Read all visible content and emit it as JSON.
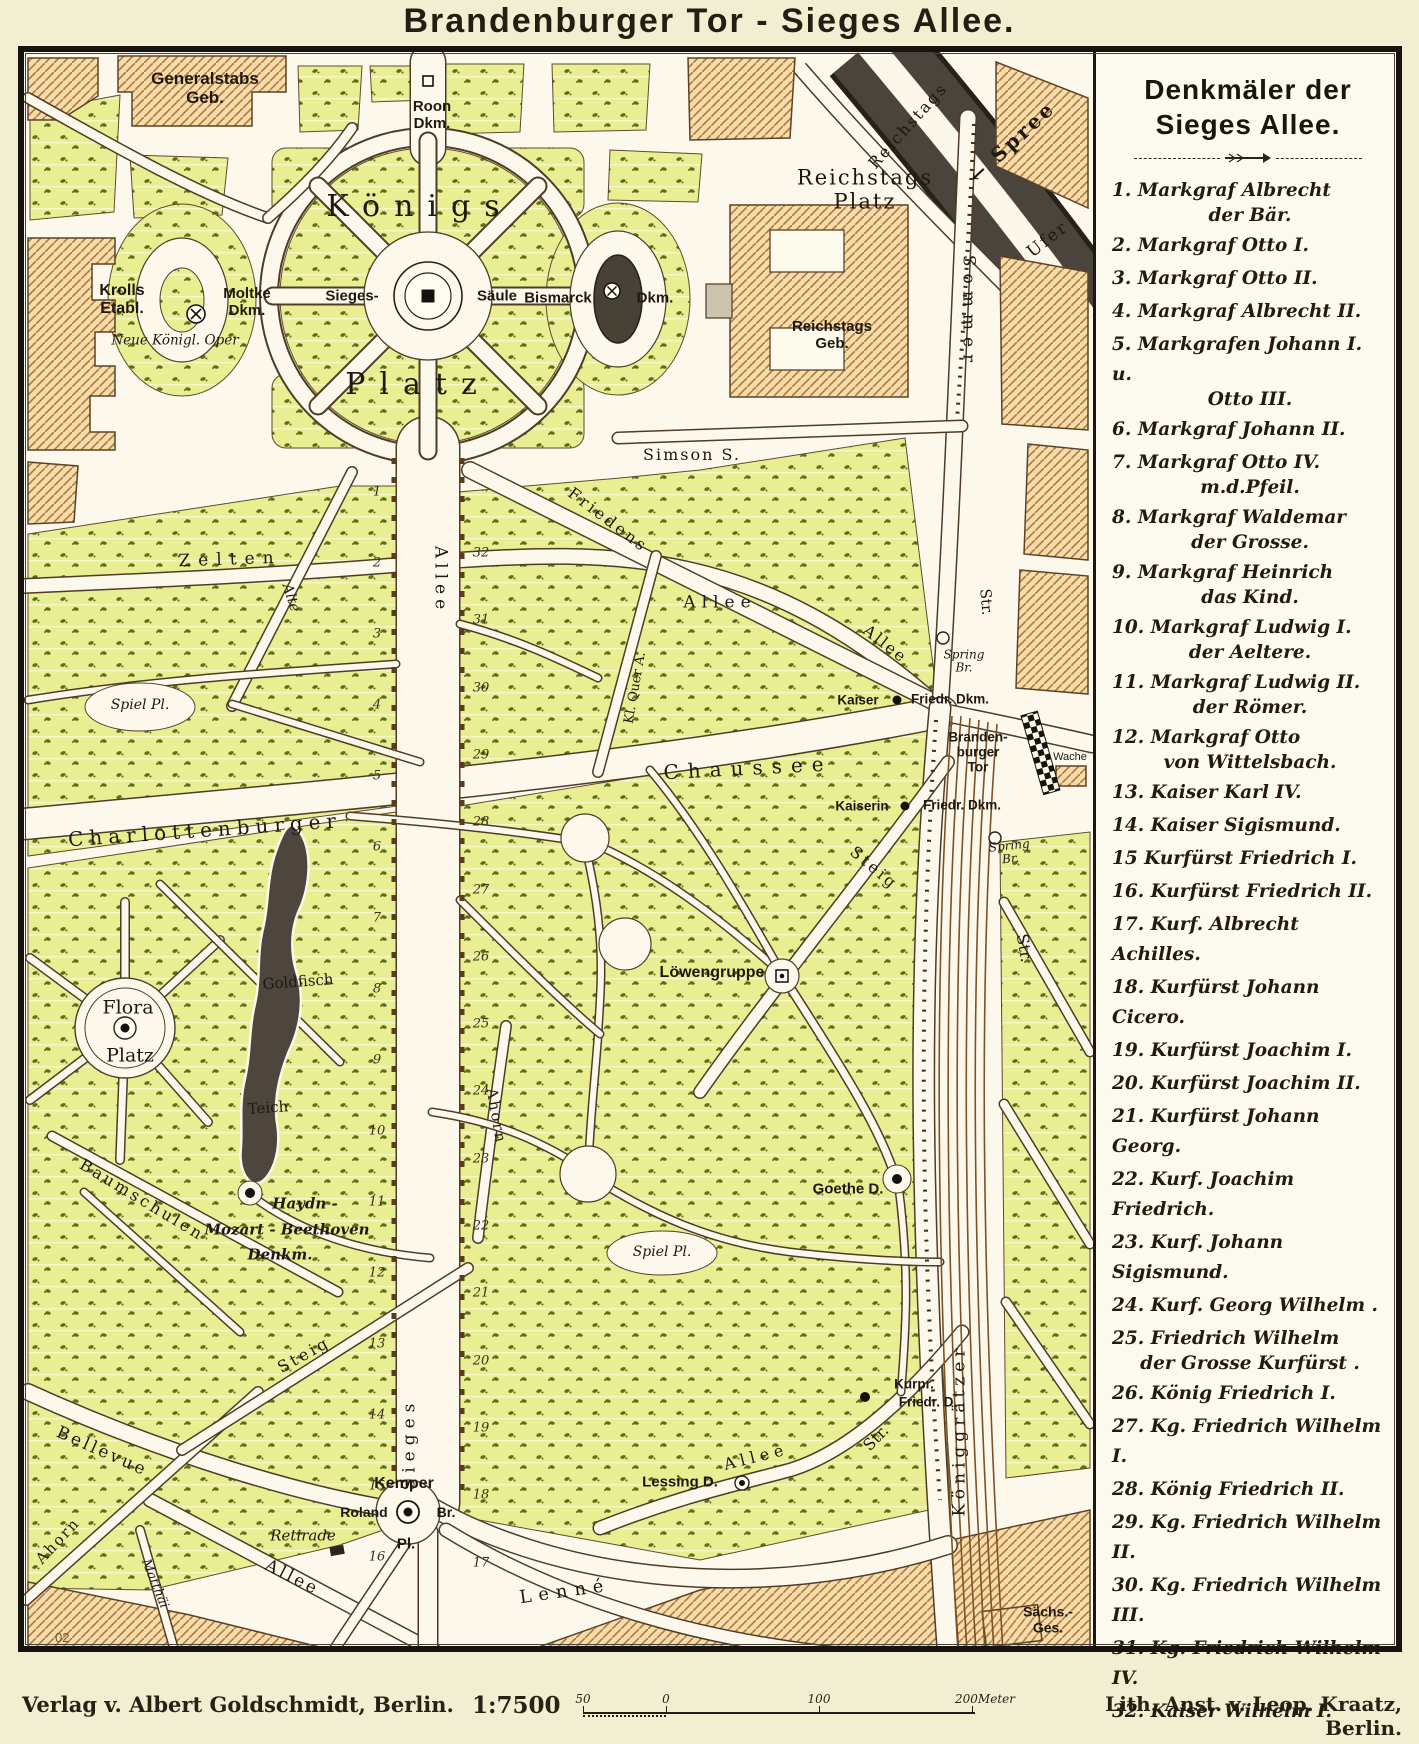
{
  "title": "Brandenburger Tor - Sieges Allee.",
  "colors": {
    "paper": "#f2eed2",
    "map_bg": "#fcf9ec",
    "park": "#e9ee92",
    "park_speckle": "#5b6c1e",
    "building_fill": "#f4dcab",
    "building_hatch": "#b5763d",
    "road_casing": "#4e3c27",
    "river_dark": "#4a443c",
    "frame": "#17130e",
    "text": "#1f1810"
  },
  "legend": {
    "title": "Denkmäler der\nSieges Allee.",
    "items": [
      {
        "n": "1.",
        "a": "Markgraf Albrecht",
        "b": "der Bär."
      },
      {
        "n": "2.",
        "a": "Markgraf Otto I.",
        "b": ""
      },
      {
        "n": "3.",
        "a": "Markgraf Otto II.",
        "b": ""
      },
      {
        "n": "4.",
        "a": "Markgraf Albrecht II.",
        "b": ""
      },
      {
        "n": "5.",
        "a": "Markgrafen Johann I. u.",
        "b": "Otto III."
      },
      {
        "n": "6.",
        "a": "Markgraf Johann II.",
        "b": ""
      },
      {
        "n": "7.",
        "a": "Markgraf Otto IV.",
        "b": "m.d.Pfeil."
      },
      {
        "n": "8.",
        "a": "Markgraf Waldemar",
        "b": "der Grosse."
      },
      {
        "n": "9.",
        "a": "Markgraf Heinrich",
        "b": "das Kind."
      },
      {
        "n": "10.",
        "a": "Markgraf Ludwig I.",
        "b": "der Aeltere."
      },
      {
        "n": "11.",
        "a": "Markgraf Ludwig II.",
        "b": "der Römer."
      },
      {
        "n": "12.",
        "a": "Markgraf Otto",
        "b": "von Wittelsbach."
      },
      {
        "n": "13.",
        "a": "Kaiser Karl IV.",
        "b": ""
      },
      {
        "n": "14.",
        "a": "Kaiser Sigismund.",
        "b": ""
      },
      {
        "n": "15",
        "a": "Kurfürst Friedrich I.",
        "b": ""
      },
      {
        "n": "16.",
        "a": "Kurfürst Friedrich II.",
        "b": ""
      },
      {
        "n": "17.",
        "a": "Kurf. Albrecht Achilles.",
        "b": ""
      },
      {
        "n": "18.",
        "a": "Kurfürst Johann Cicero.",
        "b": ""
      },
      {
        "n": "19.",
        "a": "Kurfürst Joachim I.",
        "b": ""
      },
      {
        "n": "20.",
        "a": "Kurfürst Joachim II.",
        "b": ""
      },
      {
        "n": "21.",
        "a": "Kurfürst Johann Georg.",
        "b": ""
      },
      {
        "n": "22.",
        "a": "Kurf. Joachim Friedrich.",
        "b": ""
      },
      {
        "n": "23.",
        "a": "Kurf. Johann Sigismund.",
        "b": ""
      },
      {
        "n": "24.",
        "a": "Kurf. Georg Wilhelm .",
        "b": ""
      },
      {
        "n": "25.",
        "a": "Friedrich Wilhelm",
        "b": "der Grosse Kurfürst ."
      },
      {
        "n": "26.",
        "a": "König Friedrich I.",
        "b": ""
      },
      {
        "n": "27.",
        "a": "Kg. Friedrich Wilhelm I.",
        "b": ""
      },
      {
        "n": "28.",
        "a": "König Friedrich II.",
        "b": ""
      },
      {
        "n": "29.",
        "a": "Kg. Friedrich Wilhelm II.",
        "b": ""
      },
      {
        "n": "30.",
        "a": "Kg. Friedrich Wilhelm III.",
        "b": ""
      },
      {
        "n": "31.",
        "a": "Kg. Friedrich Wilhelm IV.",
        "b": ""
      },
      {
        "n": "32.",
        "a": "Kaiser Wilhelm I.",
        "b": ""
      }
    ]
  },
  "footer": {
    "publisher": "Verlag v. Albert Goldschmidt, Berlin.",
    "scale_label": "1:7500",
    "scale_ticks": [
      "50",
      "0",
      "100",
      "200Meter"
    ],
    "lith": "Lith. Anst. v. Leop. Kraatz, Berlin.",
    "plate_no": "02"
  },
  "map": {
    "labels": [
      {
        "id": "label-generalstabs-geb",
        "t": "Generalstabs\nGeb.",
        "x": 205,
        "y": 88,
        "s": 17,
        "f": "sans",
        "b": 1
      },
      {
        "id": "label-roon-dkm",
        "t": "Roon\nDkm.",
        "x": 432,
        "y": 116,
        "s": 15,
        "f": "sans",
        "b": 1
      },
      {
        "id": "label-koenigs-platz-1",
        "t": "Königs",
        "x": 420,
        "y": 207,
        "s": 30,
        "f": "serif",
        "ls": 14
      },
      {
        "id": "label-koenigs-platz-2",
        "t": "Platz",
        "x": 418,
        "y": 385,
        "s": 30,
        "f": "serif",
        "ls": 14
      },
      {
        "id": "label-krolls-etabl",
        "t": "Krolls\nEtabl.",
        "x": 122,
        "y": 300,
        "s": 16,
        "f": "sans",
        "b": 1
      },
      {
        "id": "label-neue-koenigl-oper",
        "t": "Neue Königl. Oper",
        "x": 175,
        "y": 341,
        "s": 13.5,
        "f": "script"
      },
      {
        "id": "label-moltke-dkm",
        "t": "Moltke\nDkm.",
        "x": 247,
        "y": 303,
        "s": 15,
        "f": "sans",
        "b": 1
      },
      {
        "id": "label-sieges-saeule-1",
        "t": "Sieges-",
        "x": 352,
        "y": 297,
        "s": 15,
        "f": "sans",
        "b": 1
      },
      {
        "id": "label-sieges-saeule-2",
        "t": "Säule",
        "x": 497,
        "y": 297,
        "s": 15,
        "f": "sans",
        "b": 1
      },
      {
        "id": "label-bismarck-dkm-1",
        "t": "Bismarck",
        "x": 558,
        "y": 299,
        "s": 15,
        "f": "sans",
        "b": 1
      },
      {
        "id": "label-bismarck-dkm-2",
        "t": "Dkm.",
        "x": 655,
        "y": 299,
        "s": 15,
        "f": "sans",
        "b": 1
      },
      {
        "id": "label-reichstags-platz",
        "t": "Reichstags\nPlatz",
        "x": 865,
        "y": 190,
        "s": 21,
        "f": "serif",
        "ls": 2
      },
      {
        "id": "label-reichstags-geb",
        "t": "Reichstags\nGeb.",
        "x": 832,
        "y": 336,
        "s": 15,
        "f": "sans",
        "b": 1
      },
      {
        "id": "label-simson-str",
        "t": "Simson  S.",
        "x": 692,
        "y": 455,
        "s": 16,
        "f": "serif",
        "ls": 2
      },
      {
        "id": "label-sommer-str",
        "t": "Sommer",
        "x": 968,
        "y": 312,
        "s": 17,
        "f": "serif",
        "r": 90,
        "ls": 7
      },
      {
        "id": "label-str-sommer-s",
        "t": "Str.",
        "x": 986,
        "y": 602,
        "s": 15,
        "f": "serif",
        "r": 85
      },
      {
        "id": "label-reichstags-ufer-1",
        "t": "Reichstags",
        "x": 908,
        "y": 126,
        "s": 16,
        "f": "serif",
        "r": -48,
        "ls": 2
      },
      {
        "id": "label-reichstags-ufer-2",
        "t": "Ufer",
        "x": 1048,
        "y": 240,
        "s": 17,
        "f": "serif",
        "r": -38,
        "ls": 2
      },
      {
        "id": "label-spree",
        "t": "← Spree",
        "x": 1012,
        "y": 142,
        "s": 20,
        "f": "serif",
        "r": -43,
        "ls": 3,
        "b": 1
      },
      {
        "id": "label-zelten",
        "t": "Zelten",
        "x": 230,
        "y": 560,
        "s": 17,
        "f": "serif",
        "ls": 8,
        "r": -2
      },
      {
        "id": "label-alte",
        "t": "Alte",
        "x": 290,
        "y": 598,
        "s": 14,
        "f": "script",
        "r": 72
      },
      {
        "id": "label-allee-sieges-n",
        "t": "Allee",
        "x": 440,
        "y": 580,
        "s": 17,
        "f": "serif",
        "r": 90,
        "ls": 5
      },
      {
        "id": "label-friedens-allee-1",
        "t": "Friedens",
        "x": 608,
        "y": 520,
        "s": 16,
        "f": "serif",
        "r": 37,
        "ls": 3
      },
      {
        "id": "label-allee-mid",
        "t": "Allee",
        "x": 720,
        "y": 603,
        "s": 17,
        "f": "serif",
        "ls": 6
      },
      {
        "id": "label-friedens-allee-2",
        "t": "Allee",
        "x": 885,
        "y": 644,
        "s": 16,
        "f": "serif",
        "r": 38,
        "ls": 2
      },
      {
        "id": "label-kl-quer-allee",
        "t": "Kl. Quer A.",
        "x": 636,
        "y": 688,
        "s": 13,
        "f": "serif",
        "r": -80
      },
      {
        "id": "label-spring-br-1",
        "t": "Spring\nBr.",
        "x": 964,
        "y": 662,
        "s": 12,
        "f": "script"
      },
      {
        "id": "label-kaiser-friedrich-dkm-1",
        "t": "Kaiser",
        "x": 858,
        "y": 700,
        "s": 13.5,
        "f": "sans",
        "b": 1
      },
      {
        "id": "label-kaiser-friedrich-dkm-2",
        "t": "Friedr. Dkm.",
        "x": 950,
        "y": 699,
        "s": 13.5,
        "f": "sans",
        "b": 1
      },
      {
        "id": "label-brandenburger-tor",
        "t": "Branden-\nburger\nTor",
        "x": 978,
        "y": 752,
        "s": 13.5,
        "f": "sans",
        "b": 1
      },
      {
        "id": "label-wache",
        "t": "Wache",
        "x": 1070,
        "y": 757,
        "s": 11,
        "f": "sans"
      },
      {
        "id": "label-chaussee",
        "t": "Chaussee",
        "x": 748,
        "y": 768,
        "s": 20,
        "f": "serif",
        "ls": 9,
        "r": -3
      },
      {
        "id": "label-charlottenburger",
        "t": "Charlottenburger",
        "x": 205,
        "y": 830,
        "s": 20,
        "f": "serif",
        "ls": 6,
        "r": -4
      },
      {
        "id": "label-kaiserin-friedrich-dkm-1",
        "t": "Kaiserin",
        "x": 862,
        "y": 806,
        "s": 13.5,
        "f": "sans",
        "b": 1
      },
      {
        "id": "label-kaiserin-friedrich-dkm-2",
        "t": "Friedr. Dkm.",
        "x": 962,
        "y": 805,
        "s": 13.5,
        "f": "sans",
        "b": 1
      },
      {
        "id": "label-spring-br-2",
        "t": "Spring\nBr.",
        "x": 1010,
        "y": 853,
        "s": 12,
        "f": "script",
        "r": -6
      },
      {
        "id": "label-steig-ne",
        "t": "Steig",
        "x": 874,
        "y": 868,
        "s": 16,
        "f": "serif",
        "r": 40,
        "ls": 3
      },
      {
        "id": "label-str-koeniggraetzer-n",
        "t": "Str.",
        "x": 1024,
        "y": 948,
        "s": 16,
        "f": "serif",
        "r": 80
      },
      {
        "id": "label-flora-platz-1",
        "t": "Flora",
        "x": 128,
        "y": 1008,
        "s": 19,
        "f": "serif"
      },
      {
        "id": "label-flora-platz-2",
        "t": "Platz",
        "x": 130,
        "y": 1056,
        "s": 19,
        "f": "serif"
      },
      {
        "id": "label-goldfisch",
        "t": "Goldfisch",
        "x": 298,
        "y": 982,
        "s": 15,
        "f": "serif",
        "r": -4
      },
      {
        "id": "label-teich",
        "t": "Teich",
        "x": 268,
        "y": 1108,
        "s": 15,
        "f": "serif",
        "r": -4
      },
      {
        "id": "label-loewengruppe",
        "t": "Löwengruppe",
        "x": 712,
        "y": 973,
        "s": 16,
        "f": "sans",
        "b": 1
      },
      {
        "id": "label-spiel-pl-1",
        "t": "Spiel Pl.",
        "x": 140,
        "y": 706,
        "s": 14,
        "f": "script"
      },
      {
        "id": "label-spiel-pl-2",
        "t": "Spiel Pl.",
        "x": 662,
        "y": 1253,
        "s": 14,
        "f": "script"
      },
      {
        "id": "label-ahorn-mid",
        "t": "Ahorn",
        "x": 496,
        "y": 1116,
        "s": 15,
        "f": "serif",
        "r": 80,
        "ls": 2
      },
      {
        "id": "label-haydn-denkmal-1",
        "t": "Haydn -",
        "x": 305,
        "y": 1204,
        "s": 15,
        "f": "script",
        "b": 1
      },
      {
        "id": "label-haydn-denkmal-2",
        "t": "Mozart - Beethoven",
        "x": 287,
        "y": 1230,
        "s": 15,
        "f": "script",
        "b": 1
      },
      {
        "id": "label-haydn-denkmal-3",
        "t": "Denkm.",
        "x": 280,
        "y": 1255,
        "s": 15,
        "f": "script",
        "b": 1
      },
      {
        "id": "label-baumschulen",
        "t": "Baumschulen",
        "x": 142,
        "y": 1200,
        "s": 16,
        "f": "serif",
        "r": 31,
        "ls": 3
      },
      {
        "id": "label-steig-sw",
        "t": "Steig",
        "x": 304,
        "y": 1355,
        "s": 16,
        "f": "serif",
        "r": -29,
        "ls": 3
      },
      {
        "id": "label-bellevue",
        "t": "Bellevue",
        "x": 102,
        "y": 1452,
        "s": 17,
        "f": "serif",
        "r": 24,
        "ls": 3
      },
      {
        "id": "label-allee-bellevue",
        "t": "Allee",
        "x": 292,
        "y": 1578,
        "s": 17,
        "f": "serif",
        "r": 27,
        "ls": 3
      },
      {
        "id": "label-ahorn-sw",
        "t": "Ahorn",
        "x": 58,
        "y": 1541,
        "s": 15,
        "f": "serif",
        "r": -47,
        "ls": 2
      },
      {
        "id": "label-matthaei",
        "t": "Matthäi",
        "x": 154,
        "y": 1584,
        "s": 13,
        "f": "script",
        "r": 68
      },
      {
        "id": "label-retirade",
        "t": "Retirade",
        "x": 303,
        "y": 1536,
        "s": 15,
        "f": "script"
      },
      {
        "id": "label-sieges-allee-s",
        "t": "Sieges",
        "x": 410,
        "y": 1444,
        "s": 17,
        "f": "serif",
        "r": -90,
        "ls": 6
      },
      {
        "id": "label-kemper",
        "t": "Kemper",
        "x": 404,
        "y": 1484,
        "s": 16,
        "f": "sans",
        "b": 1
      },
      {
        "id": "label-roland",
        "t": "Roland",
        "x": 364,
        "y": 1513,
        "s": 14,
        "f": "sans",
        "b": 1
      },
      {
        "id": "label-roland-br",
        "t": "Br.",
        "x": 446,
        "y": 1513,
        "s": 14,
        "f": "sans",
        "b": 1
      },
      {
        "id": "label-kemper-pl",
        "t": "Pl.",
        "x": 406,
        "y": 1545,
        "s": 15,
        "f": "sans",
        "b": 1
      },
      {
        "id": "label-lenne",
        "t": "Lenné",
        "x": 565,
        "y": 1592,
        "s": 18,
        "f": "serif",
        "r": -8,
        "ls": 7
      },
      {
        "id": "label-lessing-d",
        "t": "Lessing D.",
        "x": 680,
        "y": 1483,
        "s": 15,
        "f": "sans",
        "b": 1
      },
      {
        "id": "label-goethe-d",
        "t": "Goethe D.",
        "x": 848,
        "y": 1190,
        "s": 15,
        "f": "sans",
        "b": 1
      },
      {
        "id": "label-kurpr-friedr-d-1",
        "t": "Kurpr.",
        "x": 914,
        "y": 1384,
        "s": 13.5,
        "f": "sans",
        "b": 1
      },
      {
        "id": "label-kurpr-friedr-d-2",
        "t": "Friedr. D.",
        "x": 928,
        "y": 1402,
        "s": 13.5,
        "f": "sans",
        "b": 1
      },
      {
        "id": "label-allee-se",
        "t": "Allee",
        "x": 756,
        "y": 1457,
        "s": 16,
        "f": "serif",
        "ls": 5,
        "r": -14
      },
      {
        "id": "label-str-se",
        "t": "Str.",
        "x": 876,
        "y": 1438,
        "s": 16,
        "f": "serif",
        "r": -46
      },
      {
        "id": "label-koeniggraetzer",
        "t": "Königgrätzer",
        "x": 960,
        "y": 1430,
        "s": 17,
        "f": "serif",
        "r": -90,
        "ls": 5
      },
      {
        "id": "label-saechs-ges",
        "t": "Sächs.-\nGes.",
        "x": 1048,
        "y": 1620,
        "s": 14,
        "f": "sans",
        "b": 1
      }
    ],
    "monument_numbers": {
      "left": {
        "x": 377,
        "y0": 492,
        "dy": 71,
        "nums": [
          1,
          2,
          3,
          4,
          5,
          6,
          7,
          8,
          9,
          10,
          11,
          12,
          13,
          14,
          15,
          16
        ]
      },
      "right": {
        "x": 481,
        "y0": 553,
        "dy": 67.3,
        "nums": [
          32,
          31,
          30,
          29,
          28,
          27,
          26,
          25,
          24,
          23,
          22,
          21,
          20,
          19,
          18,
          17
        ]
      }
    }
  }
}
